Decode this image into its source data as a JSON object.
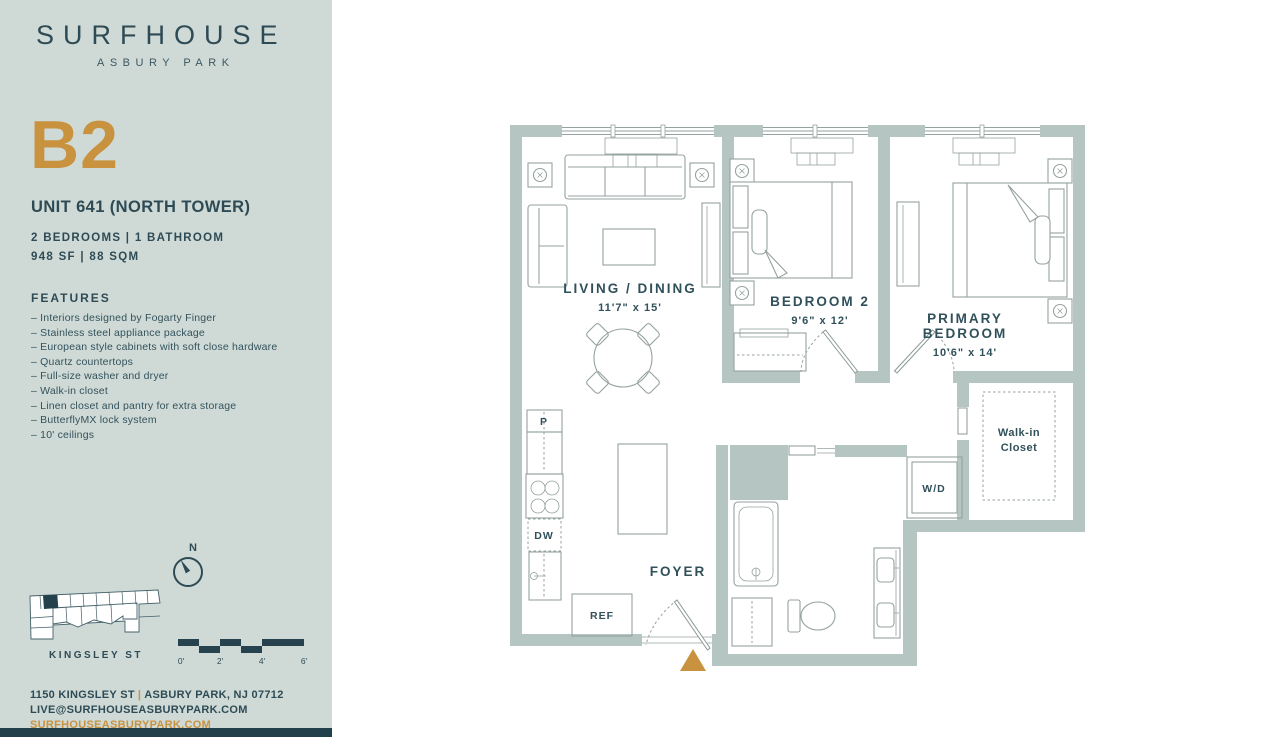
{
  "brand": {
    "name": "SURFHOUSE",
    "location": "ASBURY PARK"
  },
  "unit": {
    "plan_code": "B2",
    "title": "UNIT 641 (NORTH TOWER)",
    "specs_line1": "2 BEDROOMS | 1 BATHROOM",
    "specs_line2": "948 SF | 88 SQM"
  },
  "features": {
    "heading": "FEATURES",
    "items": [
      "Interiors designed by Fogarty Finger",
      "Stainless steel appliance package",
      "European style cabinets with soft close hardware",
      "Quartz countertops",
      "Full-size washer and dryer",
      "Walk-in closet",
      "Linen closet and pantry for extra storage",
      "ButterflyMX lock system",
      "10' ceilings"
    ]
  },
  "keyplan": {
    "north_label": "N",
    "street_label": "KINGSLEY ST"
  },
  "scale_bar": {
    "ticks": [
      "0'",
      "2'",
      "4'",
      "6'"
    ]
  },
  "contact": {
    "address_street": "1150 KINGSLEY ST",
    "address_separator": "|",
    "address_city": "ASBURY PARK, NJ 07712",
    "email": "LIVE@SURFHOUSEASBURYPARK.COM",
    "website": "SURFHOUSEASBURYPARK.COM"
  },
  "floorplan": {
    "rooms": {
      "living": {
        "name": "LIVING / DINING",
        "dims": "11'7\" x 15'"
      },
      "bedroom2": {
        "name": "BEDROOM 2",
        "dims": "9'6\" x 12'"
      },
      "primary": {
        "name_line1": "PRIMARY",
        "name_line2": "BEDROOM",
        "dims": "10'6\" x 14'"
      },
      "foyer": {
        "name": "FOYER"
      },
      "walk_in_closet": {
        "name_line1": "Walk-in",
        "name_line2": "Closet"
      }
    },
    "appliances": {
      "pantry": "P",
      "dishwasher": "DW",
      "refrigerator": "REF",
      "washer_dryer": "W/D"
    }
  },
  "colors": {
    "sidebar_bg": "#cfdad6",
    "navy": "#2e4b55",
    "accent_orange": "#c8923f",
    "wall": "#b5c6c2"
  }
}
